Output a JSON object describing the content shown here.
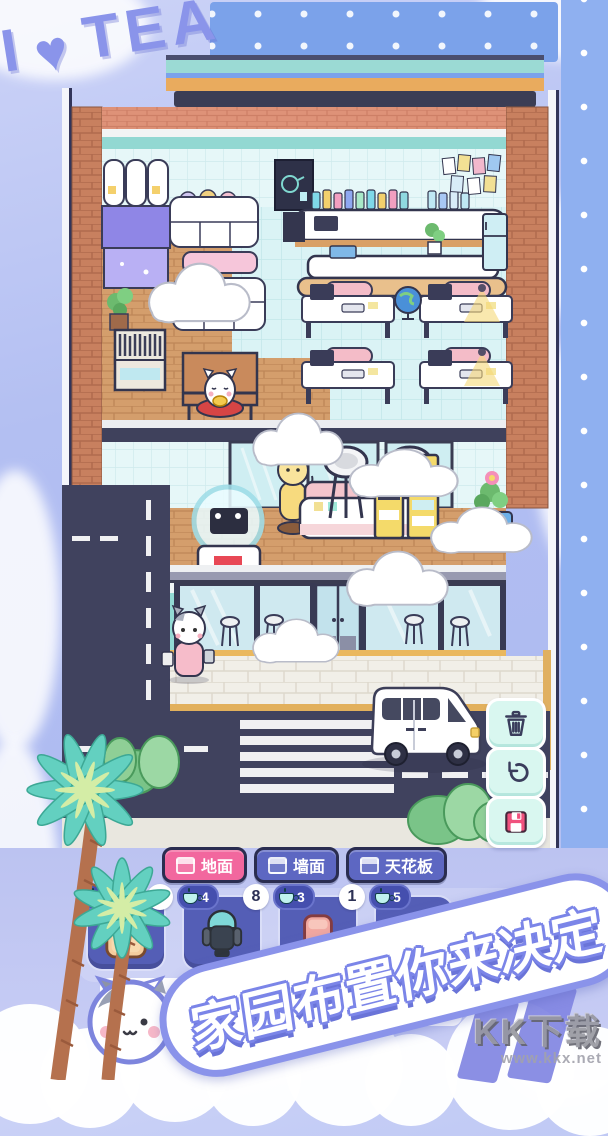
{
  "sign": {
    "i": "I",
    "heart": "♥",
    "tea": "TEA"
  },
  "tabs": [
    {
      "id": "floor",
      "label": "地面",
      "active": true,
      "color": "#f2679e"
    },
    {
      "id": "wall",
      "label": "墙面",
      "active": false,
      "color": "#5d67c2"
    },
    {
      "id": "ceiling",
      "label": "天花板",
      "active": false,
      "color": "#5d67c2"
    }
  ],
  "slots": [
    {
      "item": "tan-sofa-item",
      "price": "",
      "count": "7"
    },
    {
      "item": "massage-chair-item",
      "price": "4",
      "count": "8"
    },
    {
      "item": "pink-seat-item",
      "price": "3",
      "count": "1"
    },
    {
      "item": "covered-item",
      "price": "5",
      "count": ""
    }
  ],
  "currency_icon": "teacup-icon",
  "side_buttons": [
    {
      "icon": "trash-icon"
    },
    {
      "icon": "undo-icon"
    },
    {
      "icon": "save-icon"
    }
  ],
  "banner": {
    "text": "家园布置你来决定"
  },
  "mascot_card": {
    "fragment_top": "(面)",
    "fragment_bottom": "分类"
  },
  "item_popup": {
    "label": "地毯"
  },
  "watermark": {
    "logo": "KK下载",
    "url": "www.kkx.net"
  },
  "colors": {
    "frame": "#aebbf1",
    "roof_blue": "#7ba2ea",
    "teal": "#9bdad4",
    "orange": "#e9ab5e",
    "tab_active": "#f2679e",
    "tab_idle": "#5d67c2",
    "slot": "#545eb6",
    "button_mint": "#d9f7f0",
    "save_pink": "#f0527e",
    "road": "#40425e",
    "wood": "#d49e6c",
    "tile": "#daf3f5",
    "brick": "#c8805f",
    "banner_outline": "#7b85e8"
  }
}
